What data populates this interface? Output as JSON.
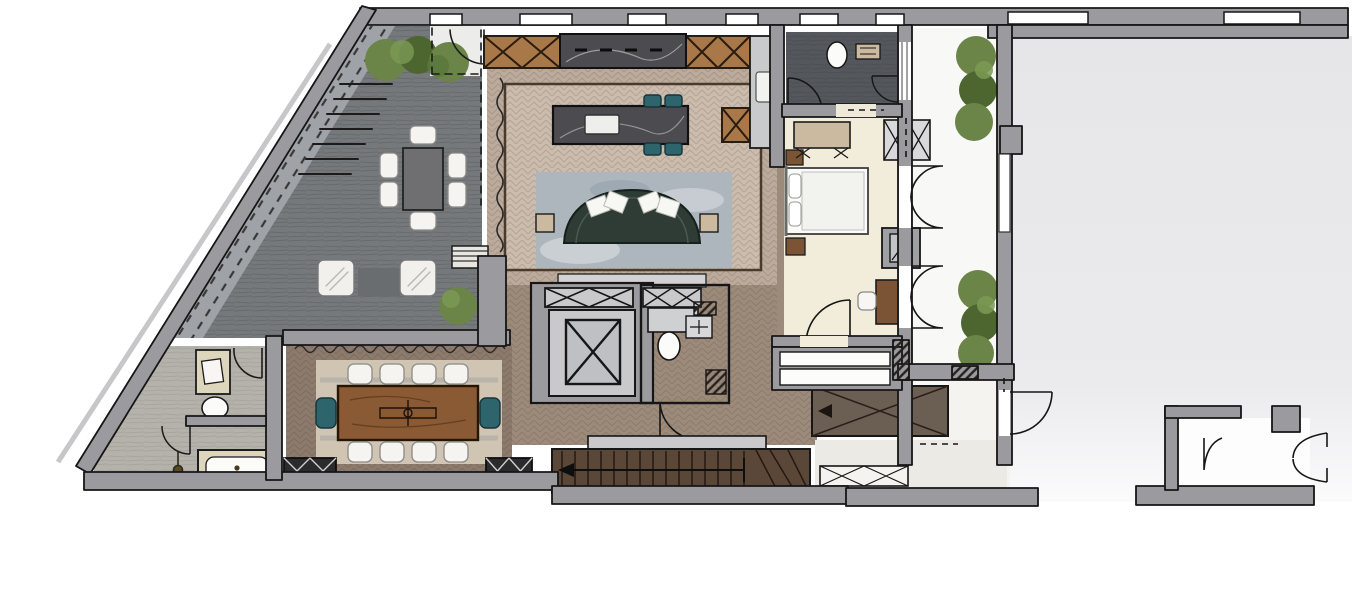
{
  "document": {
    "type": "residential-floor-plan",
    "style": "hand-rendered color sketch",
    "visible_text": []
  },
  "palette": {
    "paper": "#ffffff",
    "wall": "#9b9b9f",
    "wall_light": "#c7c7c9",
    "outline": "#1b1b1b",
    "lounge_floor": "#76797c",
    "lounge_band": "#9fa2a6",
    "slate_dark": "#54575c",
    "herringbone": "#bcab9c",
    "herringbone_light": "#cbbcad",
    "herringbone_dark": "#9c8a7b",
    "dining_floor": "#8c7b6d",
    "cream": "#f2ecda",
    "stone": "#b5b2ab",
    "courtyard": "#e8e8ea",
    "terrace": "#f8f8f6",
    "rug_blue": "#aeb6bd",
    "rug_dining": "#cfc5b2",
    "sofa_green": "#2e3c35",
    "teal": "#2e656d",
    "wood": "#a87848",
    "wood_dark": "#8a5a34",
    "marble": "#4b4b50",
    "counter_gray": "#c9cacc",
    "furn_tan": "#ded5bd",
    "bench_tan": "#cbb9a0",
    "plant": "#6b8447",
    "plant_dark": "#4d6630",
    "stair_wood": "#5a4738",
    "ramp": "#6b5e52",
    "core_light": "#c9c9cb",
    "table_gray": "#6f6f72",
    "nightstand": "#7a5434",
    "cabinet_dark": "#2b2b2e",
    "chair_white": "#f5f4f1",
    "landing": "#c9c9cb",
    "vestibule": "#ececea",
    "white": "#ffffff"
  },
  "plan": {
    "rooms": [
      {
        "name": "lounge",
        "floor": "slate gray stone",
        "furniture": [
          "dining-table",
          "6 white chairs",
          "2 armchairs",
          "striped bench",
          "diagonal stair ramp",
          "4 shrubs"
        ]
      },
      {
        "name": "kitchen-living",
        "floor": "taupe herringbone with dark border",
        "furniture": [
          "marble island with sink",
          "4 teal stools",
          "wood x-front cabinets",
          "dark marble counter with hob",
          "gray counter with sink",
          "curved green sofa",
          "4 pillows",
          "2 side tables",
          "blue rug",
          "tv console"
        ]
      },
      {
        "name": "core",
        "furniture": [
          "elevator shaft",
          "2 x-front closets",
          "wc toilet",
          "wc vanity",
          "hatched piers"
        ]
      },
      {
        "name": "dining-room",
        "floor": "dark taupe herringbone",
        "furniture": [
          "wood table",
          "8 white chairs",
          "2 teal end chairs",
          "light rug",
          "2 dark x-front wardrobes"
        ]
      },
      {
        "name": "bathroom-main",
        "floor": "light stone",
        "furniture": [
          "vanity with sink",
          "toilet",
          "bathtub",
          "shower with drain"
        ]
      },
      {
        "name": "bedroom",
        "floor": "cream carpet",
        "furniture": [
          "bed with 2 pillows",
          "2 nightstands",
          "x-leg bench",
          "desk",
          "chair",
          "mirror block",
          "x-front wardrobe",
          "2 dresser bars"
        ]
      },
      {
        "name": "bathroom-ensuite",
        "floor": "dark slate",
        "furniture": [
          "toilet",
          "shelf"
        ]
      },
      {
        "name": "terrace",
        "floor": "pale stone",
        "furniture": [
          "6 shrubs in two rows"
        ]
      },
      {
        "name": "stair-hall",
        "furniture": [
          "main stair with direction arrow",
          "winder steps",
          "landing",
          "ramp with cross lines",
          "x-front hall cabinet"
        ]
      },
      {
        "name": "entry-vestibule",
        "furniture": [
          "double swing doors",
          "single door"
        ]
      },
      {
        "name": "courtyard",
        "floor": "empty light gray"
      }
    ],
    "counts": {
      "lounge_chairs": 6,
      "dining_chairs": 8,
      "teal_end_chairs": 2,
      "island_stools": 4,
      "sofa_pillows": 4,
      "terrace_shrubs": 6,
      "lounge_shrubs": 4,
      "french_door_pairs": 2
    }
  }
}
